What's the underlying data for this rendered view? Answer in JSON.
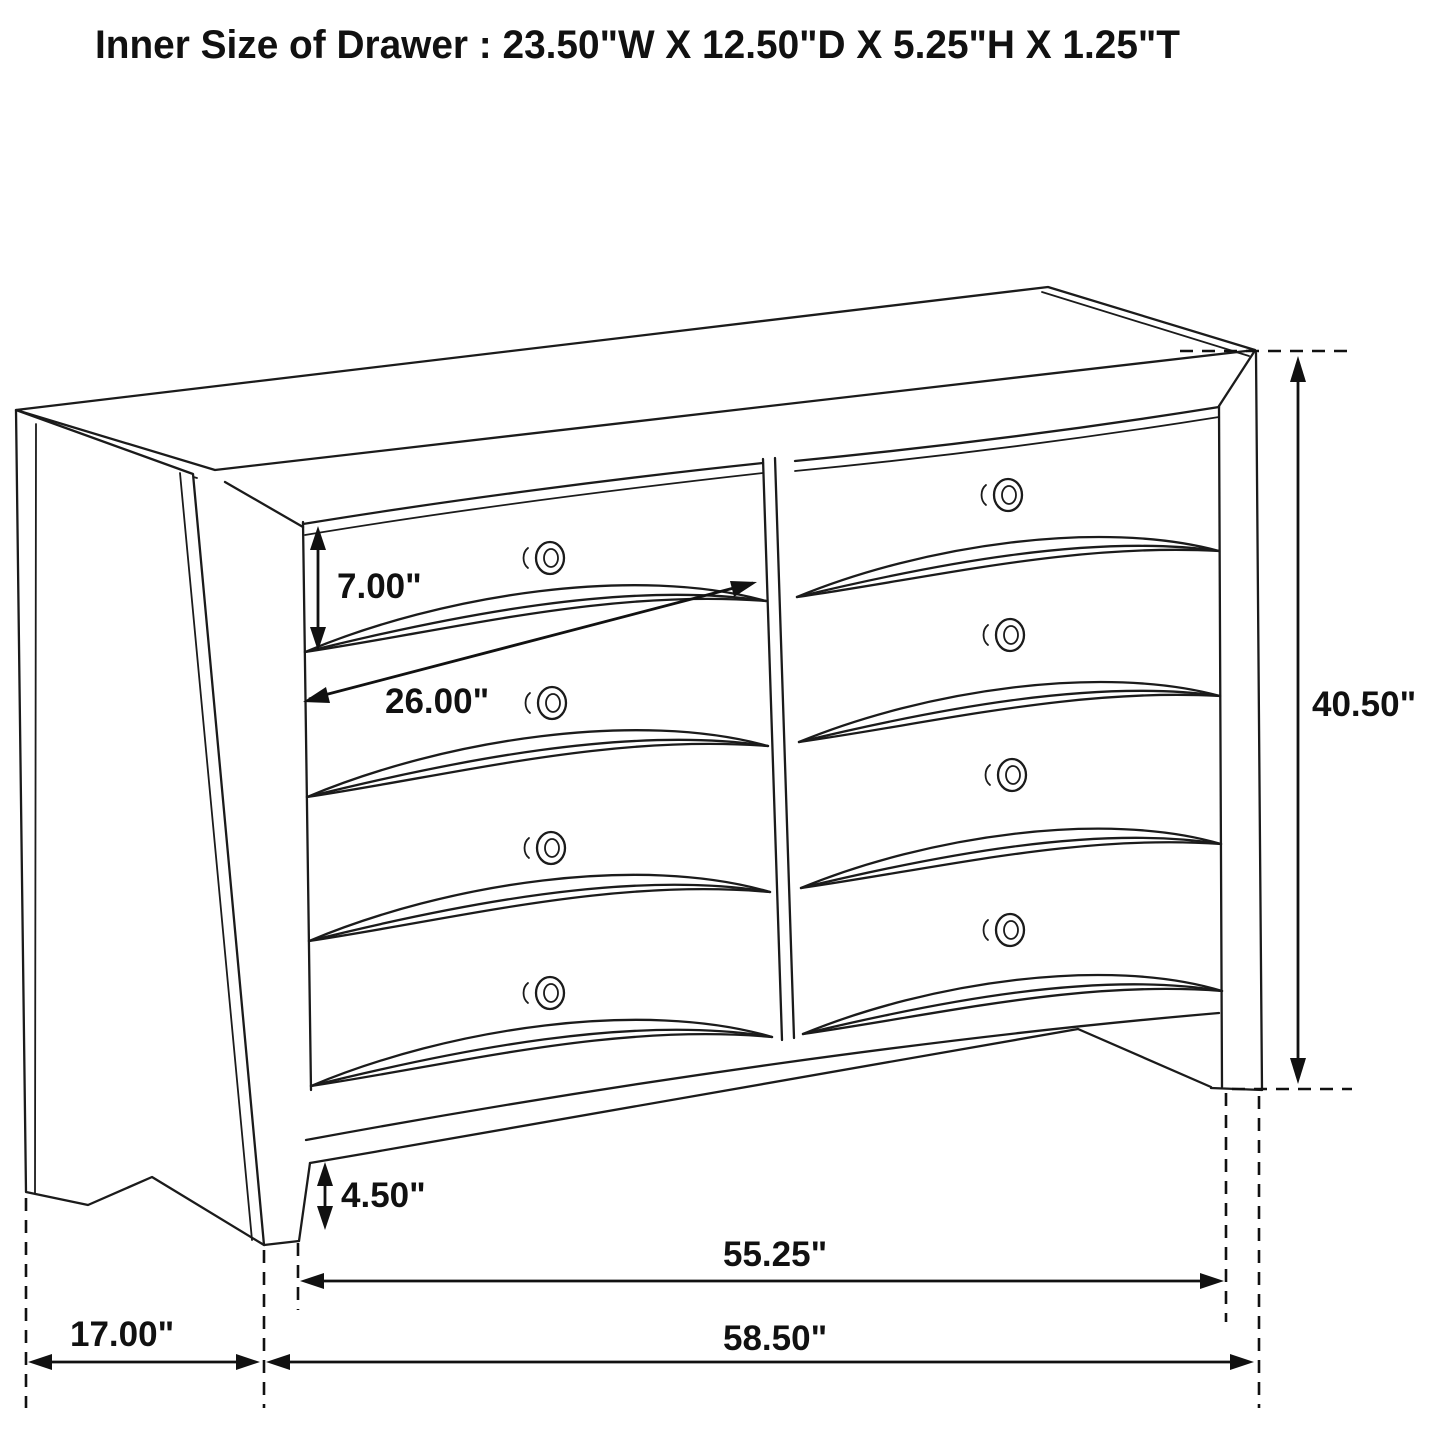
{
  "title": "Inner Size of Drawer : 23.50\"W X 12.50\"D X 5.25\"H X 1.25\"T",
  "diagram": {
    "type": "furniture-dimension-line-drawing",
    "object": "eight-drawer dresser, two columns of four drawers, perspective view",
    "inner_drawer_size": {
      "width": "23.50\"",
      "depth": "12.50\"",
      "height": "5.25\"",
      "thickness": "1.25\""
    },
    "dimensions": {
      "drawer_front_height": "7.00\"",
      "drawer_front_width": "26.00\"",
      "overall_height": "40.50\"",
      "leg_height": "4.50\"",
      "width_between_feet": "55.25\"",
      "overall_width": "58.50\"",
      "side_depth": "17.00\""
    }
  },
  "labels": {
    "drawer_height": "7.00\"",
    "drawer_width": "26.00\"",
    "overall_height": "40.50\"",
    "leg_height": "4.50\"",
    "feet_span": "55.25\"",
    "overall_width": "58.50\"",
    "depth": "17.00\""
  },
  "colors": {
    "background": "#ffffff",
    "line": "#1b1b1b",
    "dimension": "#111111"
  }
}
